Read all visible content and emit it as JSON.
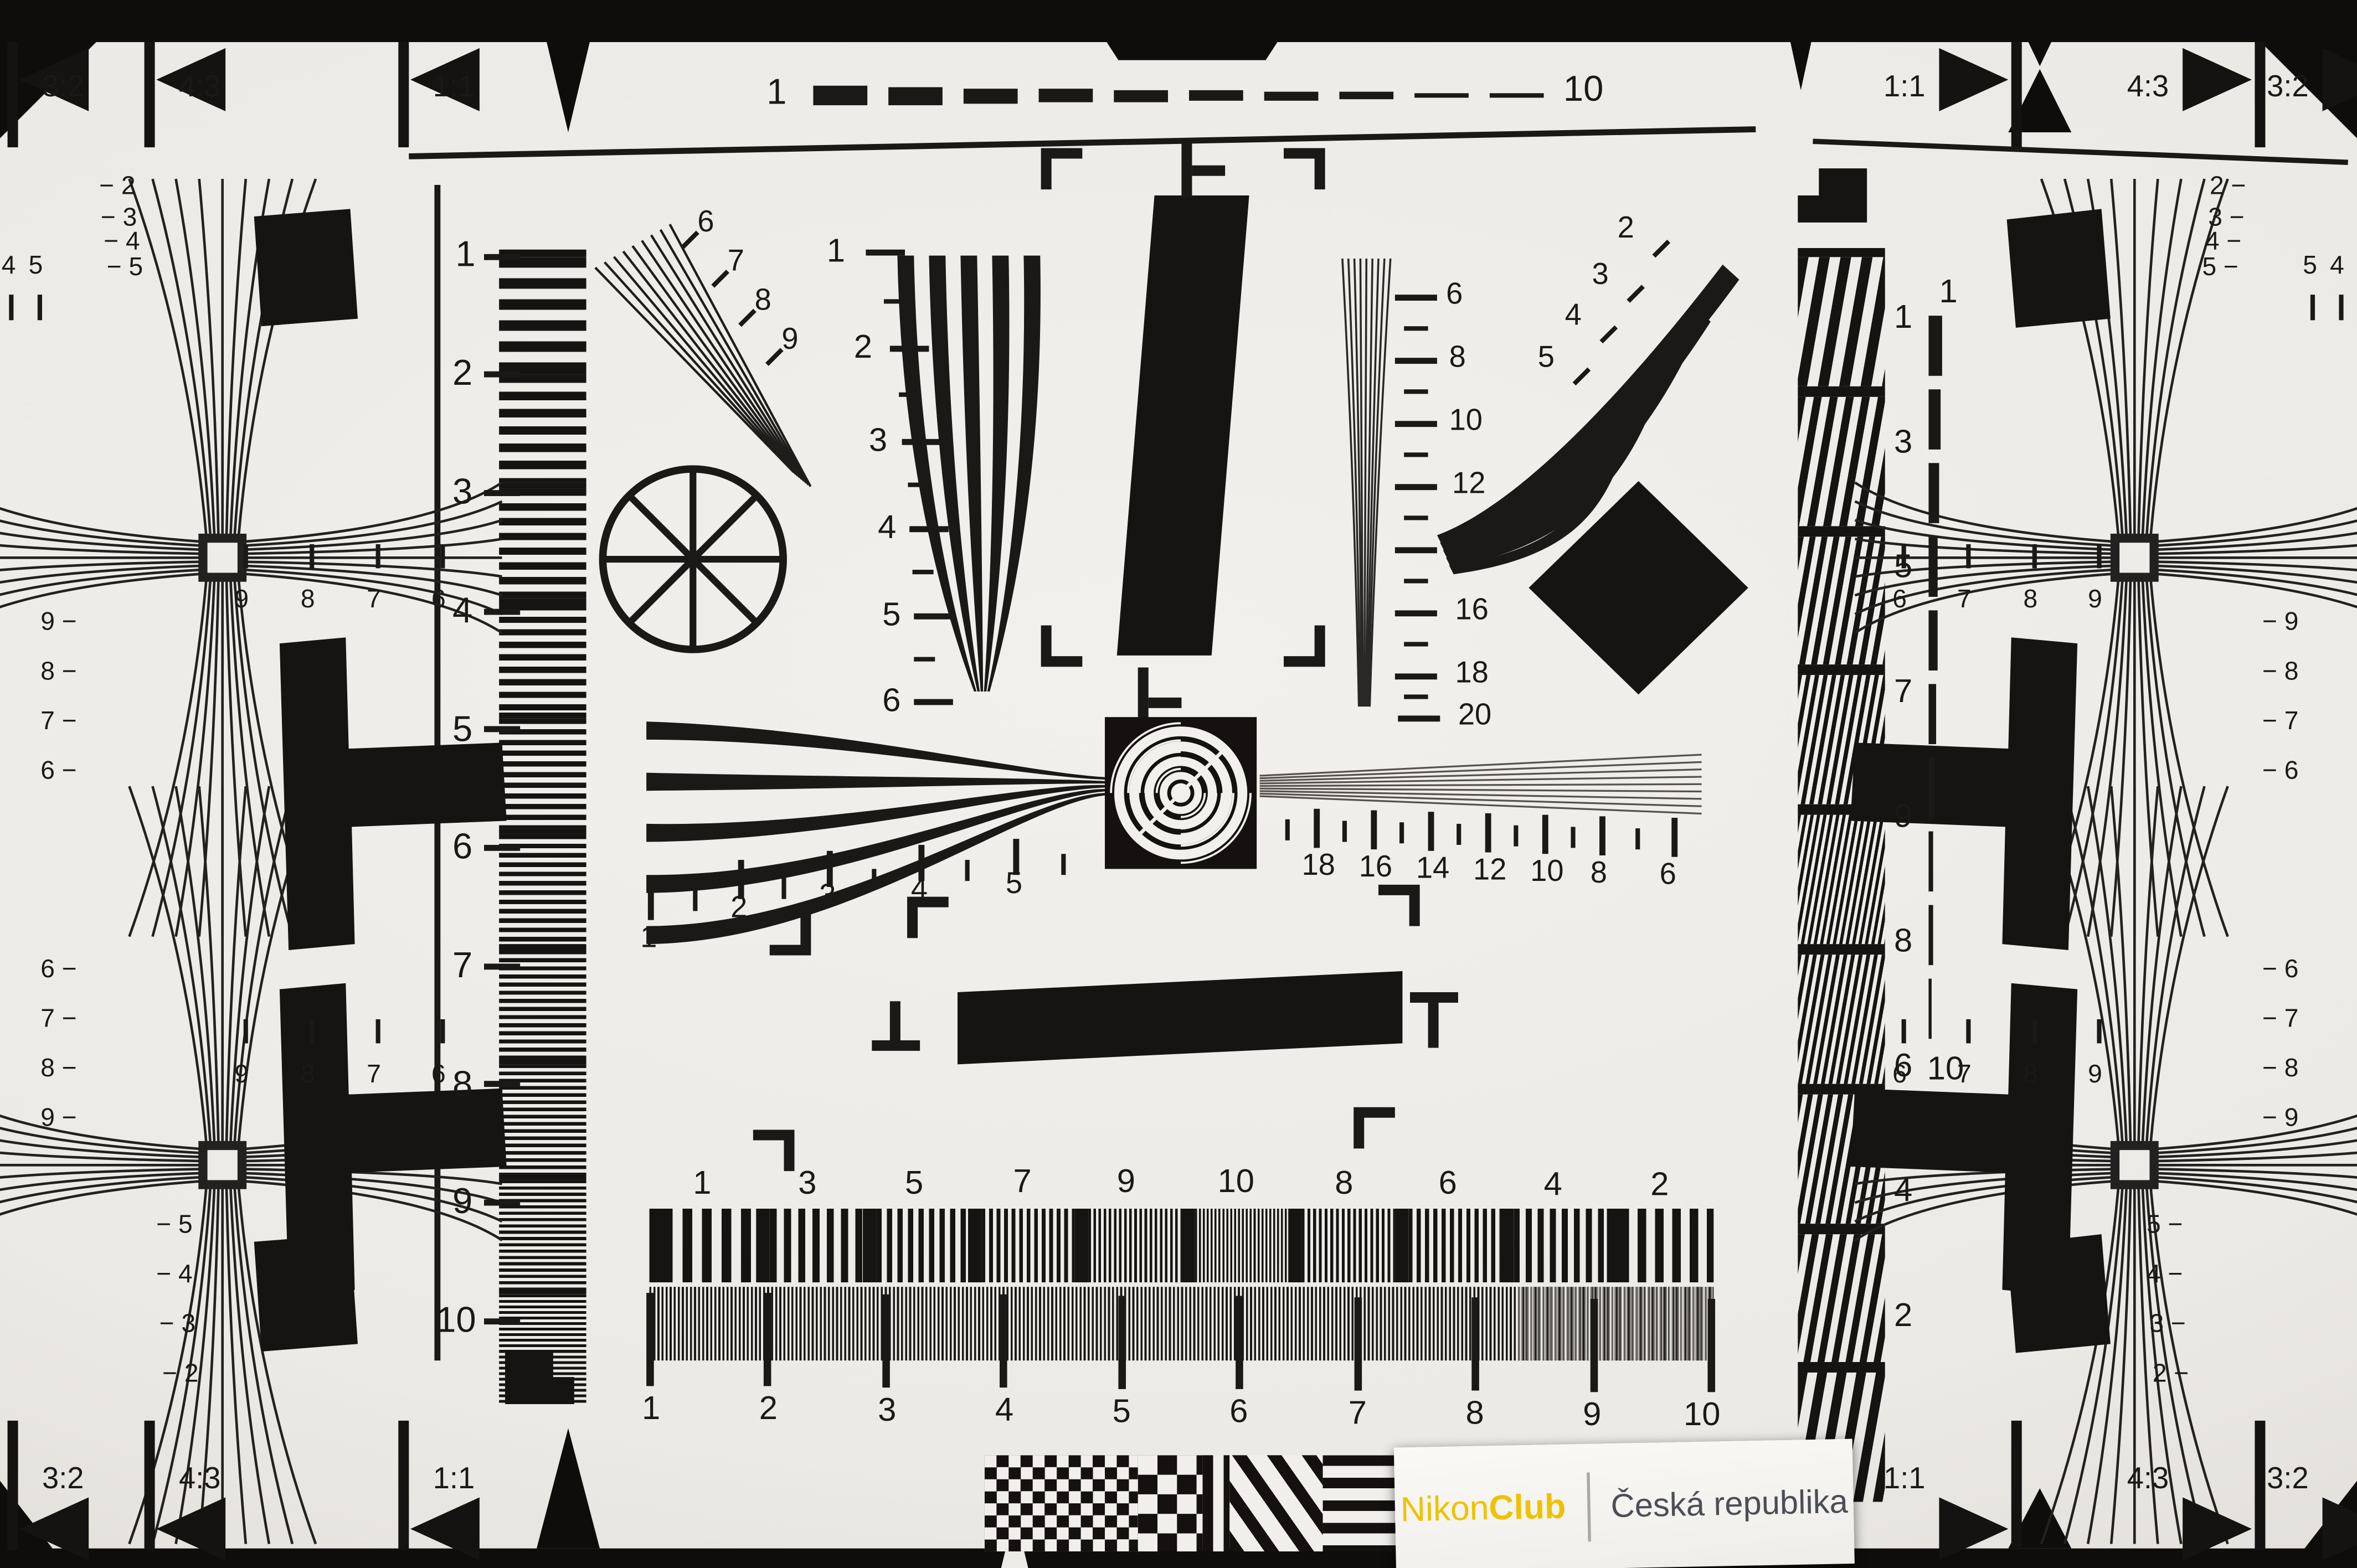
{
  "chart": {
    "corner_labels": {
      "top_left": [
        "3:2",
        "4:3",
        "1:1"
      ],
      "top_right": [
        "1:1",
        "4:3",
        "3:2"
      ],
      "bottom_left": [
        "3:2",
        "4:3",
        "1:1"
      ],
      "bottom_right": [
        "1:1",
        "4:3",
        "3:2"
      ]
    },
    "top_ruler": {
      "start": "1",
      "end": "10"
    },
    "left_scale": [
      "1",
      "2",
      "3",
      "4",
      "5",
      "6",
      "7",
      "8",
      "9",
      "10"
    ],
    "right_band_scale": [
      "1",
      "3",
      "5",
      "7",
      "9",
      "8",
      "6",
      "4",
      "2"
    ],
    "right_dashed_scale": {
      "top": "1",
      "bottom": "10"
    },
    "vertical_wedge_scale": [
      "1",
      "2",
      "3",
      "4",
      "5",
      "6"
    ],
    "fine_wedge_scale": [
      "6",
      "8",
      "10",
      "12",
      "14",
      "16",
      "18",
      "20"
    ],
    "diagonal_fan_labels": [
      "6",
      "7",
      "8",
      "9"
    ],
    "curved_fan_labels": [
      "2",
      "3",
      "4",
      "5"
    ],
    "horizontal_wedge_scale": [
      "1",
      "2",
      "3",
      "4",
      "5"
    ],
    "horizontal_wedge_scale_right": [
      "18",
      "16",
      "14",
      "12",
      "10",
      "8",
      "6"
    ],
    "bottom_block_labels": [
      "1",
      "3",
      "5",
      "7",
      "9",
      "10",
      "8",
      "6",
      "4",
      "2"
    ],
    "bottom_ruler": [
      "1",
      "2",
      "3",
      "4",
      "5",
      "6",
      "7",
      "8",
      "9",
      "10"
    ],
    "cross_top_left": {
      "wedge": [
        "− 2",
        "− 3",
        "− 4",
        "− 5"
      ],
      "pair": [
        "4",
        "5"
      ],
      "stack": [
        "9 −",
        "8 −",
        "7 −",
        "6 −"
      ],
      "row": [
        "9",
        "8",
        "7",
        "6"
      ]
    },
    "cross_top_right": {
      "wedge": [
        "2 −",
        "3 −",
        "4 −",
        "5 −"
      ],
      "pair": [
        "5",
        "4"
      ],
      "stack": [
        "− 9",
        "− 8",
        "− 7",
        "− 6"
      ],
      "row": [
        "6",
        "7",
        "8",
        "9"
      ]
    },
    "cross_bottom_left": {
      "stack": [
        "6 −",
        "7 −",
        "8 −",
        "9 −"
      ],
      "row": [
        "9",
        "8",
        "7",
        "6"
      ],
      "wedge": [
        "− 5",
        "− 4",
        "− 3",
        "− 2"
      ]
    },
    "cross_bottom_right": {
      "stack": [
        "− 6",
        "− 7",
        "− 8",
        "− 9"
      ],
      "row": [
        "6",
        "7",
        "8",
        "9"
      ],
      "wedge": [
        "5 −",
        "4 −",
        "3 −",
        "2 −"
      ]
    }
  },
  "brand": {
    "name_regular": "Nikon",
    "name_bold": "Club",
    "region": "Česká republika"
  },
  "colors": {
    "paper": "#edebe7",
    "ink": "#1b1917",
    "surround": "#131110",
    "nikon_yellow": "#eec200",
    "label_gray": "#4d4d55"
  }
}
